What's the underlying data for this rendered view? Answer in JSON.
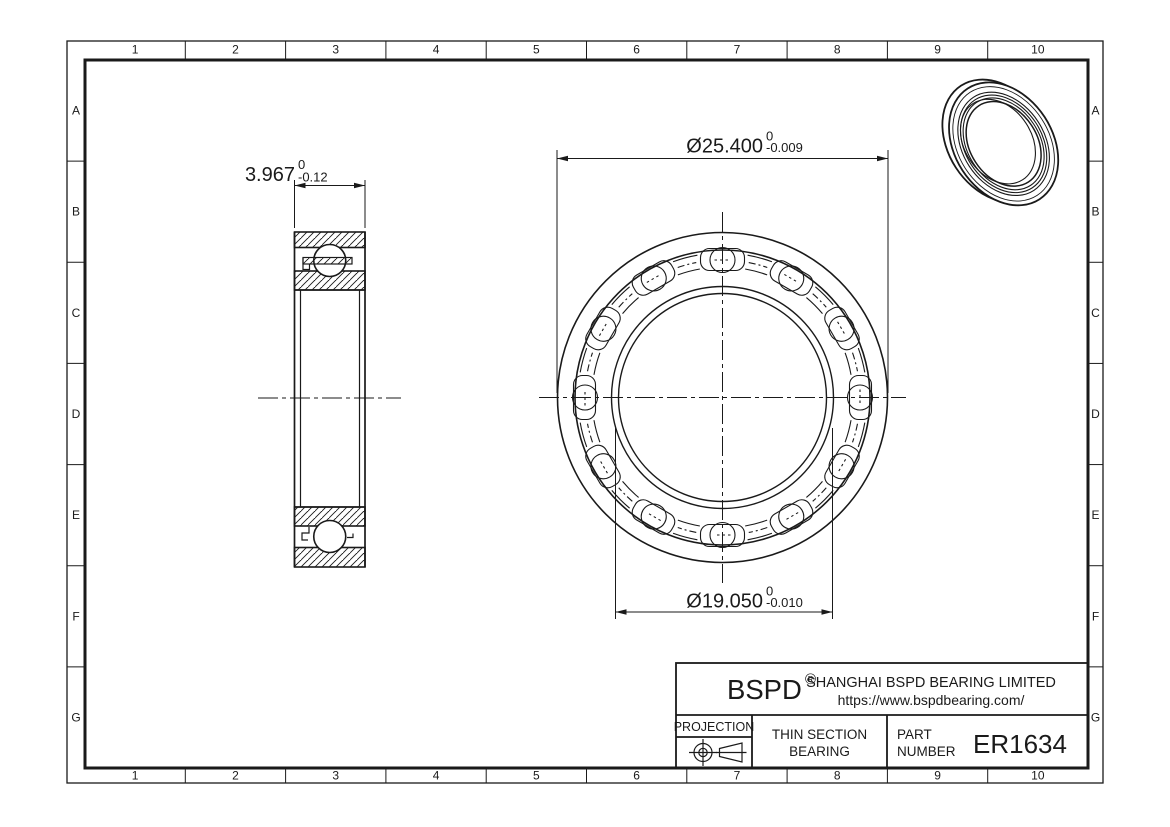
{
  "colors": {
    "line": "#1a1a1a",
    "background": "#ffffff"
  },
  "grid": {
    "cols": [
      "1",
      "2",
      "3",
      "4",
      "5",
      "6",
      "7",
      "8",
      "9",
      "10"
    ],
    "rows": [
      "A",
      "B",
      "C",
      "D",
      "E",
      "F",
      "G"
    ]
  },
  "dimensions": {
    "width": {
      "value": "3.967",
      "tol_upper": "0",
      "tol_lower": "-0.12"
    },
    "outer_diameter": {
      "value": "Ø25.400",
      "tol_upper": "0",
      "tol_lower": "-0.009"
    },
    "bore_diameter": {
      "value": "Ø19.050",
      "tol_upper": "0",
      "tol_lower": "-0.010"
    }
  },
  "front_view": {
    "ball_count": 12
  },
  "title_block": {
    "brand": "BSPD",
    "registered_mark": "®",
    "company": "SHANGHAI BSPD BEARING LIMITED",
    "website": "https://www.bspdbearing.com/",
    "projection_label": "PROJECTION",
    "product_line1": "THIN SECTION",
    "product_line2": "BEARING",
    "part_label_line1": "PART",
    "part_label_line2": "NUMBER",
    "part_number": "ER1634"
  }
}
